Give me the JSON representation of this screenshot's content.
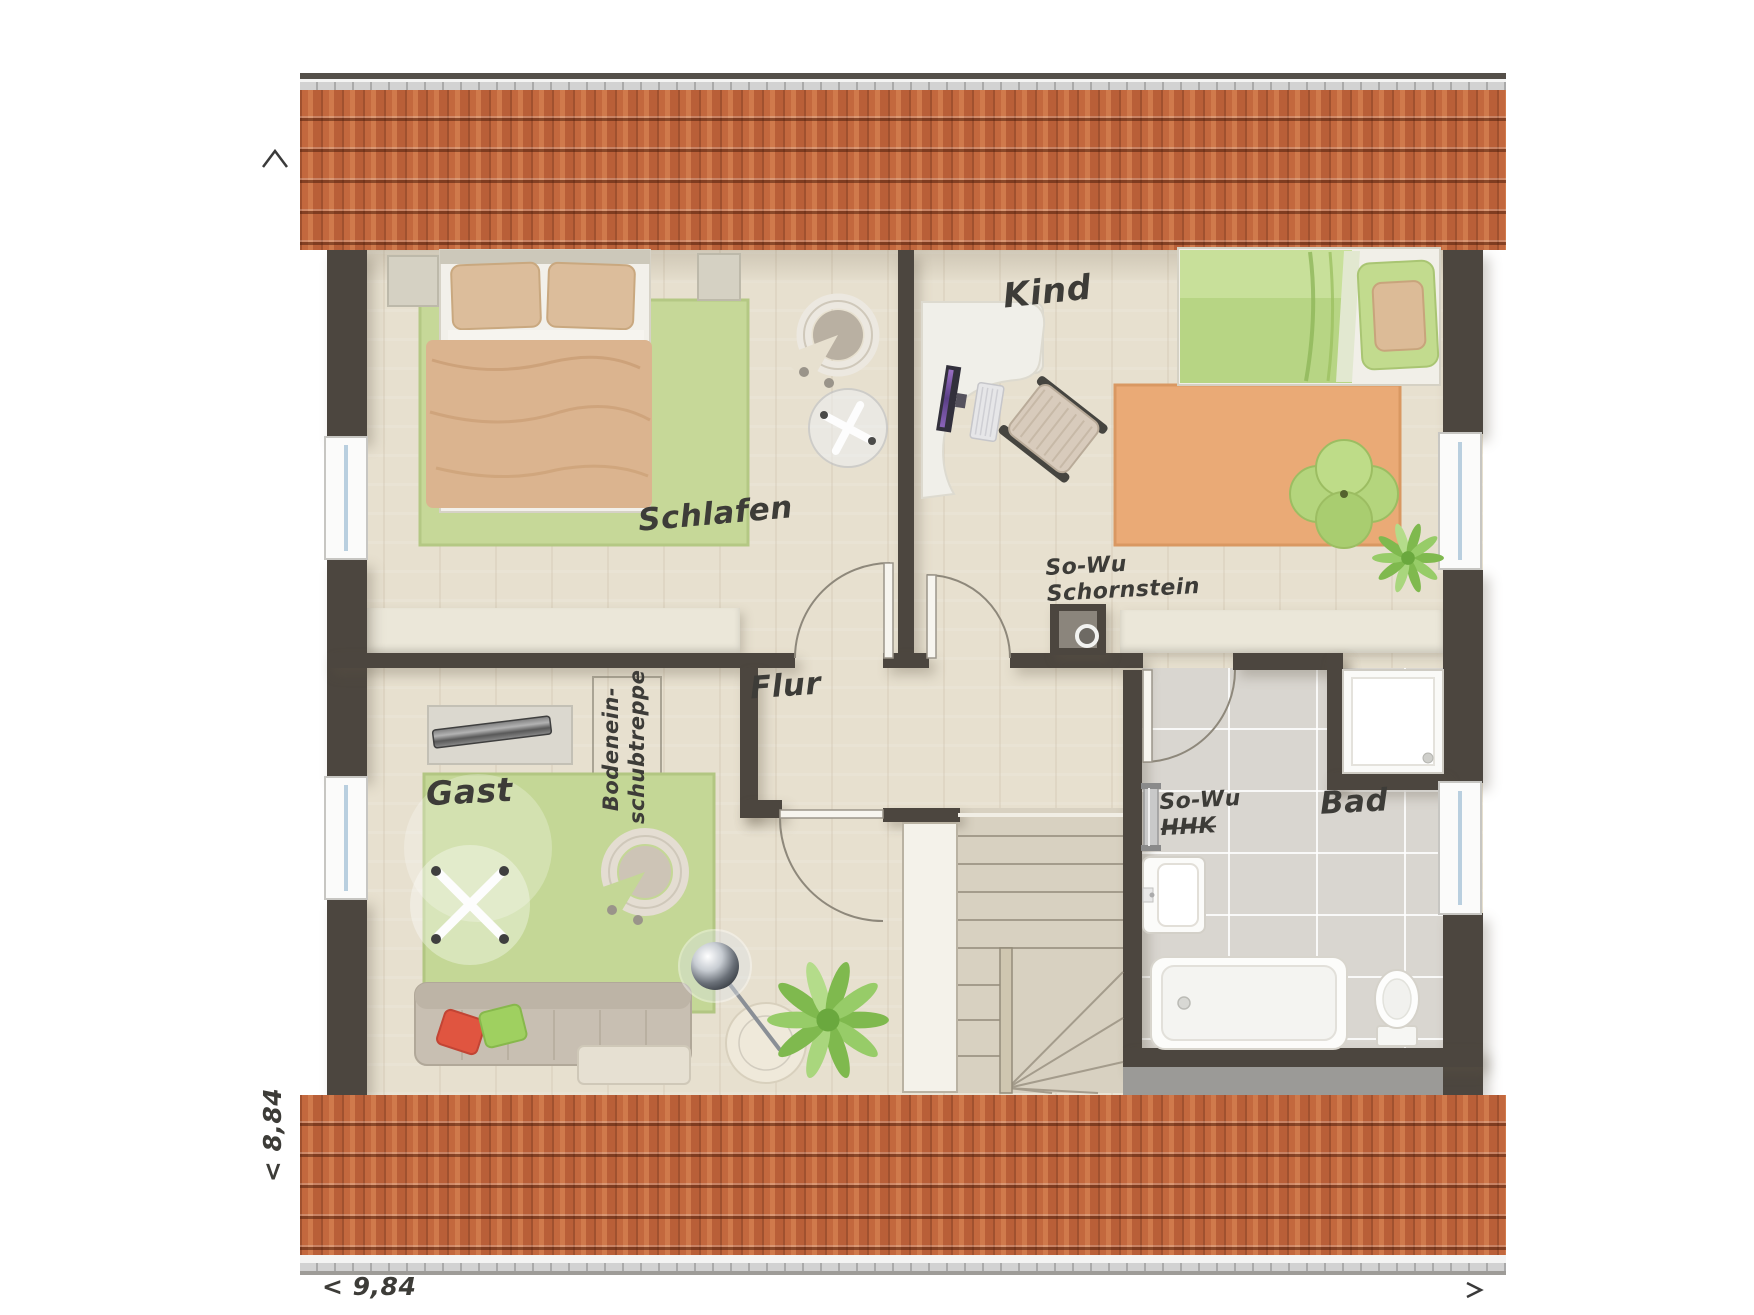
{
  "title": "Dachgeschoss Grundriss",
  "rooms": [
    {
      "id": "schlafen",
      "label": "Schlafen"
    },
    {
      "id": "kind",
      "label": "Kind"
    },
    {
      "id": "flur",
      "label": "Flur"
    },
    {
      "id": "gast",
      "label": "Gast"
    },
    {
      "id": "bad",
      "label": "Bad"
    }
  ],
  "annotations": {
    "chimney": {
      "line1": "So-Wu",
      "line2": "Schornstein"
    },
    "towel_radiator": {
      "line1": "So-Wu",
      "line2": "HHK",
      "strikethrough": true
    },
    "attic_stairs": {
      "line1": "Bodenein-",
      "line2": "schubtreppe"
    }
  },
  "dimensions": {
    "horizontal": "< 9,84",
    "vertical": "< 8,84",
    "arrow_up": "^",
    "arrow_right": ">"
  },
  "colors": {
    "wall": "#4c463f",
    "floor_wood": "#e7e0cf",
    "roof_tile": "#c3683e",
    "roof_tile_dark": "#a0512f",
    "rug_green": "#c4d796",
    "rug_orange": "#eaaa76",
    "bath_tile": "#d9d6d0",
    "knee_wall": "#ebe7d9",
    "duvet_tan": "#dbb48f",
    "duvet_green": "#b7d584",
    "cushion_red": "#e05540",
    "cushion_green": "#9fd060",
    "label_ink": "#3d3c38"
  }
}
